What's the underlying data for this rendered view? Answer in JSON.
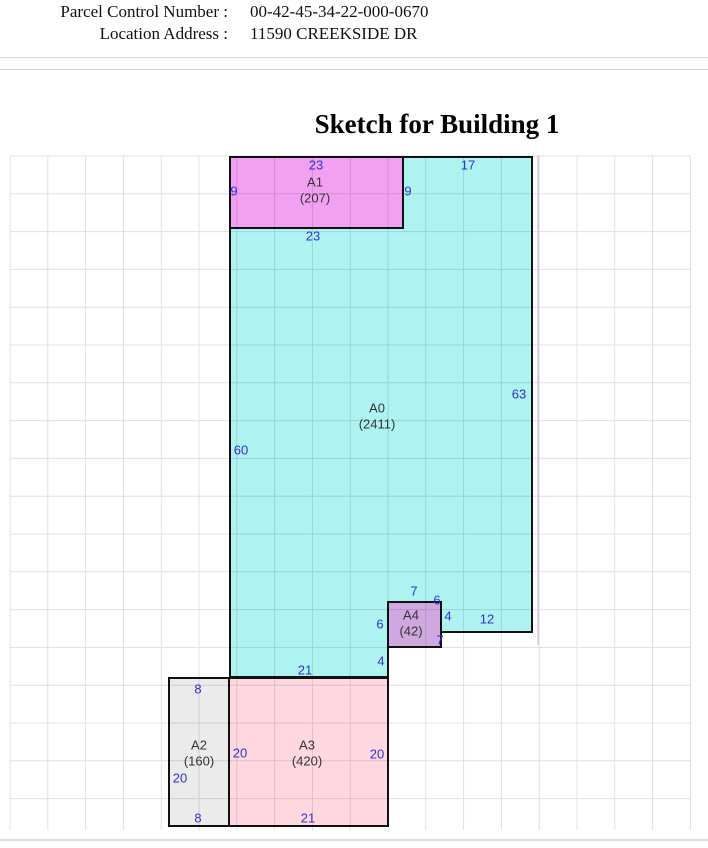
{
  "header": {
    "fields": [
      {
        "label": "Parcel Control Number :",
        "value": "00-42-45-34-22-000-0670"
      },
      {
        "label": "Location Address :",
        "value": "11590 CREEKSIDE DR"
      }
    ]
  },
  "title": "Sketch for Building 1",
  "sketch": {
    "stroke_color": "#111111",
    "dimension_color": "#3333cc",
    "areas": [
      {
        "code": "A0",
        "sqft": "(2411)",
        "fill": "#aef2f2",
        "points": [
          [
            403,
            157
          ],
          [
            532,
            157
          ],
          [
            532,
            632
          ],
          [
            441,
            632
          ],
          [
            441,
            602
          ],
          [
            388,
            602
          ],
          [
            388,
            677
          ],
          [
            230,
            677
          ],
          [
            230,
            228
          ],
          [
            403,
            228
          ]
        ],
        "label": {
          "x": 377,
          "y": 408
        }
      },
      {
        "code": "A1",
        "sqft": "(207)",
        "fill": "#f2a0f2",
        "points": [
          [
            230,
            157
          ],
          [
            403,
            157
          ],
          [
            403,
            228
          ],
          [
            230,
            228
          ]
        ],
        "label": {
          "x": 315,
          "y": 182
        }
      },
      {
        "code": "A4",
        "sqft": "(42)",
        "fill": "#d0a8e0",
        "points": [
          [
            388,
            602
          ],
          [
            441,
            602
          ],
          [
            441,
            647
          ],
          [
            388,
            647
          ]
        ],
        "label": {
          "x": 411,
          "y": 615
        }
      },
      {
        "code": "A2",
        "sqft": "(160)",
        "fill": "#ebebeb",
        "points": [
          [
            169,
            678
          ],
          [
            229,
            678
          ],
          [
            229,
            826
          ],
          [
            169,
            826
          ]
        ],
        "label": {
          "x": 199,
          "y": 745
        }
      },
      {
        "code": "A3",
        "sqft": "(420)",
        "fill": "#ffd7e0",
        "points": [
          [
            229,
            678
          ],
          [
            388,
            678
          ],
          [
            388,
            826
          ],
          [
            229,
            826
          ]
        ],
        "label": {
          "x": 307,
          "y": 745
        }
      }
    ],
    "dimensions": [
      {
        "text": "23",
        "x": 316,
        "y": 165
      },
      {
        "text": "17",
        "x": 468,
        "y": 165
      },
      {
        "text": "9",
        "x": 234,
        "y": 191
      },
      {
        "text": "9",
        "x": 408,
        "y": 191
      },
      {
        "text": "23",
        "x": 313,
        "y": 236
      },
      {
        "text": "63",
        "x": 519,
        "y": 394
      },
      {
        "text": "60",
        "x": 241,
        "y": 450
      },
      {
        "text": "7",
        "x": 414,
        "y": 591
      },
      {
        "text": "6",
        "x": 437,
        "y": 600
      },
      {
        "text": "4",
        "x": 448,
        "y": 616
      },
      {
        "text": "6",
        "x": 380,
        "y": 624
      },
      {
        "text": "7",
        "x": 440,
        "y": 640
      },
      {
        "text": "12",
        "x": 487,
        "y": 619
      },
      {
        "text": "4",
        "x": 381,
        "y": 661
      },
      {
        "text": "21",
        "x": 305,
        "y": 670
      },
      {
        "text": "8",
        "x": 198,
        "y": 689
      },
      {
        "text": "20",
        "x": 180,
        "y": 778
      },
      {
        "text": "8",
        "x": 198,
        "y": 818
      },
      {
        "text": "20",
        "x": 240,
        "y": 753
      },
      {
        "text": "20",
        "x": 377,
        "y": 754
      },
      {
        "text": "21",
        "x": 308,
        "y": 818
      }
    ]
  }
}
